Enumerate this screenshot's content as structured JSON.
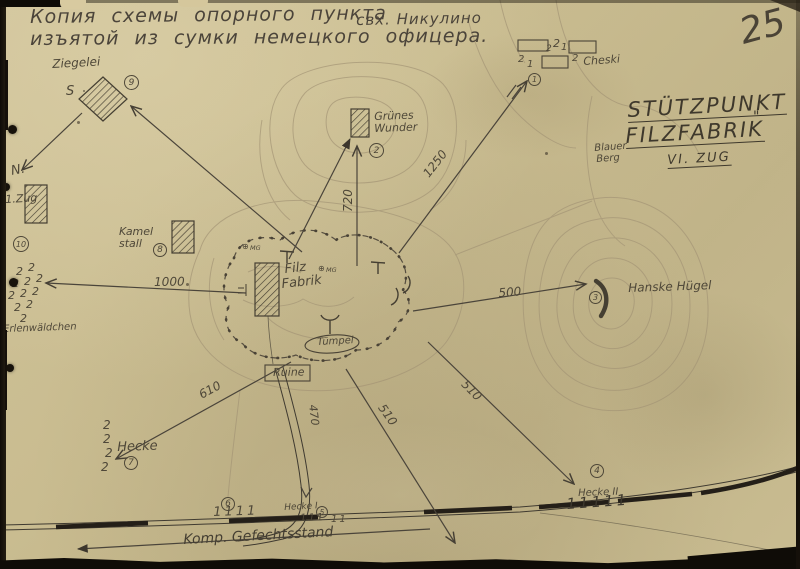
{
  "document": {
    "title_line1a": "Копия  схемы  опорного  пункта",
    "title_line1b": "свх. Никулино",
    "title_line2": "изъятой  из  сумки  немецкого  офицера.",
    "page_number": "25"
  },
  "map_title": {
    "line1": "STÜTZPUNKT",
    "line2": "FILZFABRIK",
    "quote": "\"",
    "line3": "VI. ZUG",
    "hill_label_1": "Blauer",
    "hill_label_2": "Berg"
  },
  "places": {
    "ziegelei": "Ziegelei",
    "ziegelei_s": "S",
    "zug1": "1.Zug",
    "north_mark": "N.",
    "erlenwaeldchen": "Erlenwäldchen",
    "kamel_1": "Kamel",
    "kamel_2": "stall",
    "gruenes_1": "Grünes",
    "gruenes_2": "Wunder",
    "filz_1": "Filz",
    "filz_2": "Fabrik",
    "tuempel": "Tümpel",
    "ruine": "Ruine",
    "hanske": "Hanske Hügel",
    "cheski": "Cheski",
    "hecke": "Hecke",
    "hecke_i": "Hecke I",
    "hecke_ii": "Hecke II",
    "gefechtsstand": "Komp. Gefechtsstand",
    "mg": "MG"
  },
  "distances": {
    "west": "1000",
    "north": "720",
    "northeast": "1250",
    "east": "500",
    "southwest": "610",
    "south_road": "470",
    "south": "510",
    "southeast": "510"
  },
  "position_numbers": {
    "p1": "1",
    "p2": "2",
    "p3": "3",
    "p4": "4",
    "p5": "5",
    "p6": "6",
    "p7": "7",
    "p8": "8",
    "p9": "9",
    "p10": "10"
  },
  "symbols": {
    "tree2": "2",
    "squad_1": "1",
    "squad_2": "2",
    "mg_symbol": "⊕",
    "trees_row_2": "11",
    "trees_row_3": "111",
    "trees_row_4": "1111",
    "trees_row_5": "11111"
  }
}
